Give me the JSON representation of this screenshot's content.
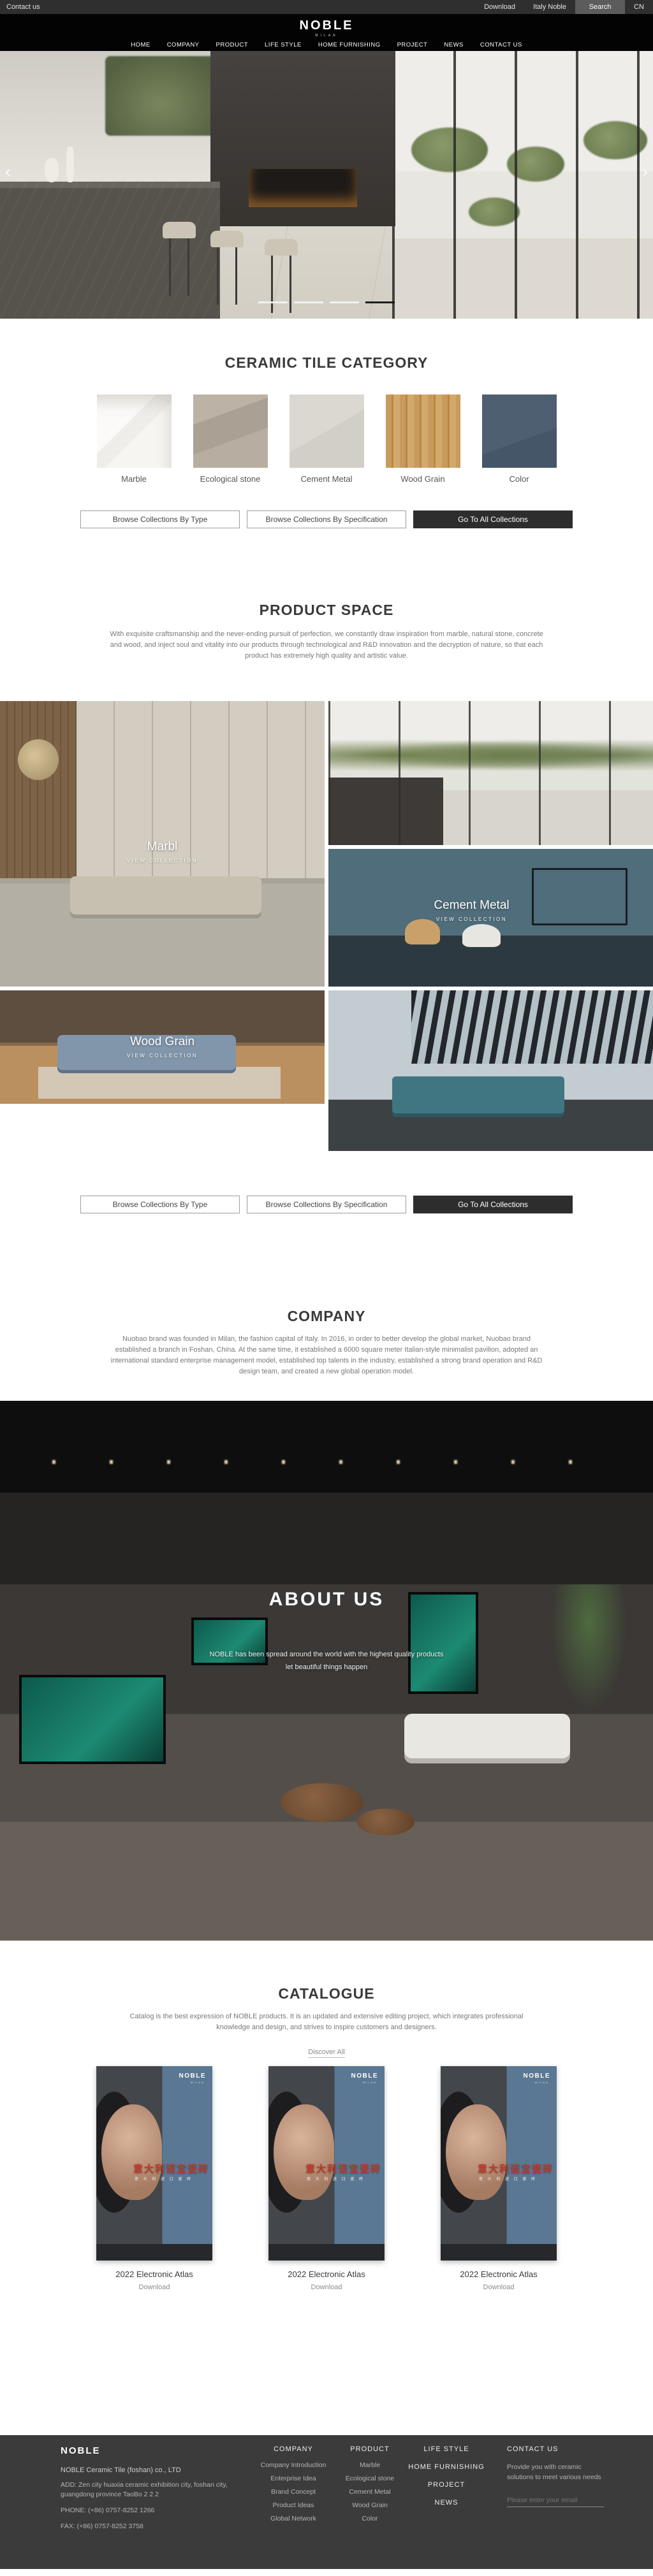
{
  "topbar": {
    "contact_us": "Contact us",
    "download": "Download",
    "italy_noble": "Italy Noble",
    "search": "Search",
    "lang": "CN"
  },
  "nav": {
    "logo": "NOBLE",
    "logo_sub": "MILAN",
    "items": [
      "HOME",
      "COMPANY",
      "PRODUCT",
      "LIFE STYLE",
      "HOME FURNISHING",
      "PROJECT",
      "NEWS",
      "CONTACT US"
    ]
  },
  "hero": {
    "prev": "‹",
    "next": "›",
    "slide_count": 4,
    "active_slide": 4
  },
  "buttons": {
    "by_type": "Browse Collections By Type",
    "by_spec": "Browse Collections By Specification",
    "all": "Go To All Collections"
  },
  "category": {
    "title": "CERAMIC TILE CATEGORY",
    "tiles": [
      {
        "label": "Marble",
        "color": "#f7f5f2"
      },
      {
        "label": "Ecological stone",
        "color": "#b0a69a"
      },
      {
        "label": "Cement Metal",
        "color": "#d6d3cd"
      },
      {
        "label": "Wood Grain",
        "color": "#c2965c"
      },
      {
        "label": "Color",
        "color": "#4a5c6e"
      }
    ]
  },
  "product_space": {
    "title": "PRODUCT SPACE",
    "description": "With exquisite craftsmanship and the never-ending pursuit of perfection, we constantly draw inspiration from marble, natural stone, concrete and wood, and inject soul and vitality into our products through technological and R&D innovation and the decryption of nature, so that each product has extremely high quality and artistic value.",
    "cards": [
      {
        "title": "Marbl",
        "subtitle": "VIEW COLLECTION"
      },
      {
        "title": "Cement Metal",
        "subtitle": "VIEW COLLECTION"
      },
      {
        "title": "Wood Grain",
        "subtitle": "VIEW COLLECTION"
      }
    ]
  },
  "company": {
    "title": "COMPANY",
    "description": "Nuobao brand was founded in Milan, the fashion capital of Italy. In 2016, in order to better develop the global market, Nuobao brand established a branch in Foshan, China. At the same time, it established a 6000 square meter Italian-style minimalist pavilion, adopted an international standard enterprise management model, established top talents in the industry, established a strong brand operation and R&D design team, and created a new global operation model."
  },
  "about": {
    "title": "ABOUT US",
    "line1": "NOBLE has been spread around the world with the highest quality products",
    "line2": "let beautiful things happen"
  },
  "catalogue": {
    "title": "CATALOGUE",
    "description": "Catalog is the best expression of NOBLE products. It is an updated and extensive editing project, which integrates professional knowledge and design, and strives to inspire customers and designers.",
    "discover": "Discover All",
    "poster": {
      "brand": "NOBLE",
      "brand_sub": "MILAN",
      "headline": "意大利诺宝瓷砖",
      "subline": "意 大 利 进 口 瓷 砖"
    },
    "items": [
      {
        "title": "2022 Electronic Atlas",
        "action": "Download"
      },
      {
        "title": "2022 Electronic Atlas",
        "action": "Download"
      },
      {
        "title": "2022 Electronic Atlas",
        "action": "Download"
      }
    ]
  },
  "footer": {
    "logo": "NOBLE",
    "company_name": "NOBLE Ceramic Tile (foshan) co., LTD",
    "address": "ADD:  Zen city huaxia ceramic exhibition city, foshan city, guangdong province TaoBo 2 2 2",
    "phone": "PHONE:   (+86) 0757-8252 1266",
    "fax": "FAX:   (+86) 0757-8252 3758",
    "col_company": {
      "header": "COMPANY",
      "items": [
        "Company Introduction",
        "Enterprise Idea",
        "Brand Concept",
        "Product Ideas",
        "Global Network"
      ]
    },
    "col_product": {
      "header": "PRODUCT",
      "items": [
        "Marble",
        "Ecological stone",
        "Cement Metal",
        "Wood Grain",
        "Color"
      ]
    },
    "col_links": [
      "LIFE STYLE",
      "HOME FURNISHING",
      "PROJECT",
      "NEWS"
    ],
    "contact": {
      "header": "CONTACT US",
      "text": "Provide you with ceramic solutions to meet various needs",
      "email_placeholder": "Please enter your email"
    }
  },
  "theme": {
    "topbar_bg": "#2f2f2f",
    "nav_bg": "#030303",
    "footer_bg": "#3b3b3b",
    "dark_button_bg": "#2d2d2d",
    "heading_color": "#3a3a3a",
    "poster_blue": "#5a7894",
    "poster_red": "#c0392b"
  }
}
